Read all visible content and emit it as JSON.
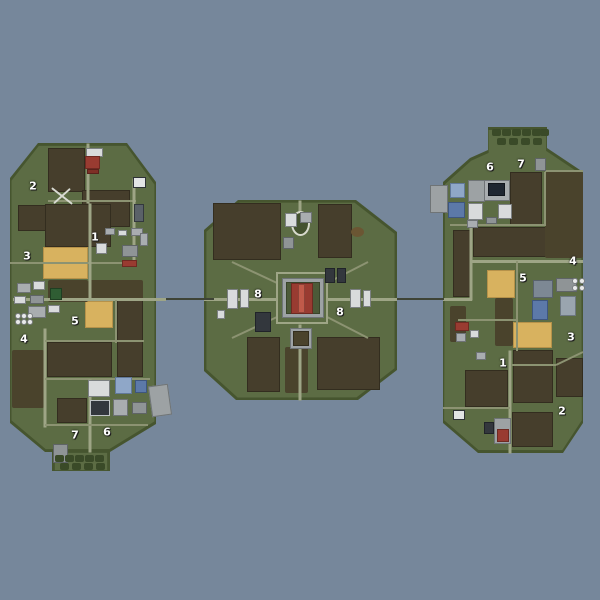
{
  "map_title": "",
  "colors": {
    "water": "#76879B",
    "land": "#5C6C44",
    "land_edge": "#46552F",
    "field_dark": "#463E2C",
    "field_dark_border": "#332D1F",
    "field_yellow": "#D8B25F",
    "field_yellow_border": "#B6924A",
    "road": "#9EA586",
    "road_minor": "#8C9372",
    "bridge": "#3F4436",
    "forest": "#4A432C",
    "hedge": "#3A4A28",
    "dirt": "#6B5633",
    "oval_ring": "#D8DACD",
    "oval_inner": "#44522F",
    "cross": "#D8DAD2",
    "silo": "#E9EAEA",
    "silo_border": "#7A7E80",
    "marker_text": "#FFFFFF"
  },
  "palette": {
    "white": [
      "#D9DBDC",
      "#7C8082"
    ],
    "gray": [
      "#A9ADB0",
      "#6F7376"
    ],
    "gray2": [
      "#8F9496",
      "#5F6466"
    ],
    "pad": [
      "#9DA2A4",
      "#6F7476"
    ],
    "dark": [
      "#33373D",
      "#202329"
    ],
    "navy": [
      "#1F2631",
      "#12161D"
    ],
    "blue": [
      "#5C79A8",
      "#3E567E"
    ],
    "blue2": [
      "#8FA7C8",
      "#62799A"
    ],
    "bluegray": [
      "#7D8894",
      "#59626C"
    ],
    "bluegray2": [
      "#9AA5AF",
      "#6E7881"
    ],
    "red": [
      "#993B31",
      "#6E2A22"
    ],
    "red2": [
      "#7E2F26",
      "#5A211B"
    ],
    "redLight": [
      "#C05A4A",
      "#8E4237"
    ],
    "green": [
      "#2F5D33",
      "#1F3F22"
    ],
    "green2": [
      "#4C5A38",
      "#39452A"
    ],
    "frame": [
      "#E2E4E5",
      "#2E3236"
    ],
    "panel": [
      "#5A6168",
      "#33383D"
    ],
    "darkframe": [
      "#33373D",
      "#C0C4C6"
    ],
    "forestPatch": [
      "#4A432C",
      "#332E1D"
    ]
  },
  "islands": [
    {
      "name": "west",
      "points": [
        [
          38,
          143
        ],
        [
          127,
          143
        ],
        [
          156,
          182
        ],
        [
          156,
          424
        ],
        [
          110,
          452
        ],
        [
          45,
          452
        ],
        [
          10,
          423
        ],
        [
          10,
          178
        ]
      ]
    },
    {
      "name": "west-spit",
      "points": [
        [
          52,
          452
        ],
        [
          110,
          452
        ],
        [
          110,
          471
        ],
        [
          52,
          471
        ]
      ]
    },
    {
      "name": "center",
      "points": [
        [
          238,
          200
        ],
        [
          356,
          200
        ],
        [
          397,
          232
        ],
        [
          397,
          370
        ],
        [
          358,
          400
        ],
        [
          236,
          400
        ],
        [
          204,
          371
        ],
        [
          204,
          230
        ]
      ]
    },
    {
      "name": "east",
      "points": [
        [
          470,
          158
        ],
        [
          488,
          150
        ],
        [
          488,
          127
        ],
        [
          547,
          127
        ],
        [
          547,
          148
        ],
        [
          583,
          172
        ],
        [
          583,
          423
        ],
        [
          563,
          453
        ],
        [
          478,
          453
        ],
        [
          443,
          423
        ],
        [
          443,
          182
        ]
      ]
    }
  ],
  "fields": [
    [
      48,
      148,
      37,
      44,
      "d"
    ],
    [
      18,
      205,
      28,
      26,
      "d"
    ],
    [
      82,
      190,
      48,
      37,
      "d"
    ],
    [
      45,
      204,
      66,
      43,
      "d"
    ],
    [
      43,
      247,
      45,
      32,
      "y"
    ],
    [
      85,
      301,
      28,
      27,
      "y"
    ],
    [
      117,
      300,
      26,
      77,
      "d"
    ],
    [
      47,
      342,
      65,
      35,
      "d"
    ],
    [
      57,
      398,
      30,
      25,
      "d"
    ],
    [
      213,
      203,
      68,
      57,
      "d"
    ],
    [
      318,
      204,
      34,
      54,
      "d"
    ],
    [
      247,
      337,
      33,
      55,
      "d"
    ],
    [
      317,
      337,
      63,
      53,
      "d"
    ],
    [
      510,
      172,
      32,
      53,
      "d"
    ],
    [
      473,
      227,
      77,
      30,
      "d"
    ],
    [
      453,
      230,
      19,
      67,
      "d"
    ],
    [
      487,
      270,
      28,
      28,
      "y"
    ],
    [
      513,
      322,
      39,
      26,
      "y"
    ],
    [
      513,
      350,
      40,
      53,
      "d"
    ],
    [
      556,
      358,
      27,
      39,
      "d"
    ],
    [
      465,
      370,
      43,
      37,
      "d"
    ],
    [
      512,
      412,
      41,
      35,
      "d"
    ]
  ],
  "forests": [
    [
      48,
      280,
      40,
      22
    ],
    [
      12,
      350,
      32,
      58
    ],
    [
      88,
      280,
      55,
      20
    ],
    [
      285,
      347,
      23,
      46
    ],
    [
      545,
      172,
      38,
      86
    ],
    [
      495,
      298,
      18,
      48
    ],
    [
      450,
      306,
      16,
      36
    ]
  ],
  "roads": [
    [
      88,
      143,
      88,
      203,
      3
    ],
    [
      48,
      201,
      136,
      201,
      2
    ],
    [
      134,
      178,
      134,
      263,
      3
    ],
    [
      10,
      263,
      134,
      263,
      2
    ],
    [
      90,
      203,
      90,
      300,
      3
    ],
    [
      13,
      299,
      166,
      299,
      3
    ],
    [
      116,
      300,
      116,
      343,
      2
    ],
    [
      45,
      328,
      45,
      427,
      3
    ],
    [
      45,
      341,
      144,
      341,
      2
    ],
    [
      45,
      379,
      150,
      379,
      2
    ],
    [
      90,
      379,
      90,
      452,
      3
    ],
    [
      45,
      425,
      148,
      425,
      2
    ],
    [
      300,
      200,
      300,
      225,
      3
    ],
    [
      204,
      299,
      277,
      299,
      3
    ],
    [
      327,
      299,
      397,
      299,
      3
    ],
    [
      300,
      324,
      300,
      400,
      3
    ],
    [
      232,
      262,
      277,
      283,
      2
    ],
    [
      368,
      262,
      327,
      283,
      2
    ],
    [
      232,
      338,
      277,
      317,
      2
    ],
    [
      368,
      338,
      327,
      317,
      2
    ],
    [
      443,
      299,
      472,
      299,
      3
    ],
    [
      471,
      225,
      471,
      300,
      3
    ],
    [
      450,
      225,
      546,
      225,
      2
    ],
    [
      545,
      172,
      545,
      225,
      2
    ],
    [
      545,
      171,
      583,
      171,
      2
    ],
    [
      472,
      261,
      583,
      261,
      3
    ],
    [
      517,
      261,
      517,
      351,
      2
    ],
    [
      458,
      320,
      517,
      320,
      2
    ],
    [
      510,
      350,
      510,
      453,
      3
    ],
    [
      512,
      365,
      556,
      365,
      2
    ],
    [
      556,
      365,
      583,
      352,
      2
    ],
    [
      443,
      408,
      510,
      408,
      2
    ]
  ],
  "rings": [
    [
      276,
      272,
      52,
      52
    ]
  ],
  "ovals": [
    [
      300,
      223,
      19,
      25,
      "ring"
    ],
    [
      357,
      232,
      13,
      10,
      "dirt"
    ]
  ],
  "bridges": [
    [
      166,
      298,
      214,
      298
    ],
    [
      397,
      298,
      444,
      298
    ]
  ],
  "buildings": [
    [
      86,
      148,
      17,
      9,
      "white"
    ],
    [
      85,
      156,
      15,
      13,
      "red"
    ],
    [
      87,
      169,
      12,
      5,
      "red2"
    ],
    [
      133,
      177,
      13,
      11,
      "frame"
    ],
    [
      134,
      204,
      10,
      18,
      "panel"
    ],
    [
      105,
      228,
      10,
      7,
      "gray"
    ],
    [
      118,
      230,
      9,
      6,
      "white"
    ],
    [
      131,
      228,
      12,
      8,
      "gray"
    ],
    [
      122,
      245,
      16,
      12,
      "gray2"
    ],
    [
      96,
      243,
      11,
      11,
      "white"
    ],
    [
      122,
      260,
      15,
      7,
      "red"
    ],
    [
      140,
      233,
      8,
      13,
      "gray"
    ],
    [
      17,
      283,
      14,
      10,
      "gray"
    ],
    [
      33,
      281,
      12,
      9,
      "white"
    ],
    [
      50,
      288,
      12,
      12,
      "green"
    ],
    [
      30,
      295,
      14,
      9,
      "gray2"
    ],
    [
      14,
      296,
      12,
      8,
      "white"
    ],
    [
      28,
      306,
      18,
      12,
      "gray"
    ],
    [
      48,
      305,
      12,
      8,
      "white"
    ],
    [
      88,
      380,
      22,
      17,
      "white"
    ],
    [
      115,
      377,
      17,
      17,
      "blue2"
    ],
    [
      135,
      380,
      12,
      13,
      "blue"
    ],
    [
      90,
      400,
      20,
      16,
      "darkframe"
    ],
    [
      113,
      399,
      15,
      17,
      "gray"
    ],
    [
      132,
      402,
      15,
      12,
      "gray2"
    ],
    [
      150,
      385,
      20,
      31,
      "pad",
      -8
    ],
    [
      53,
      444,
      15,
      19,
      "gray2"
    ],
    [
      285,
      213,
      12,
      14,
      "white"
    ],
    [
      300,
      212,
      12,
      11,
      "gray"
    ],
    [
      283,
      237,
      11,
      12,
      "gray2"
    ],
    [
      325,
      268,
      10,
      15,
      "dark"
    ],
    [
      337,
      268,
      9,
      15,
      "dark"
    ],
    [
      282,
      278,
      42,
      40,
      "pad"
    ],
    [
      286,
      282,
      34,
      32,
      "green2"
    ],
    [
      291,
      283,
      22,
      31,
      "red"
    ],
    [
      298,
      284,
      7,
      29,
      "redLight"
    ],
    [
      227,
      289,
      11,
      20,
      "white"
    ],
    [
      240,
      289,
      9,
      19,
      "white"
    ],
    [
      350,
      289,
      11,
      19,
      "white"
    ],
    [
      363,
      290,
      8,
      17,
      "white"
    ],
    [
      255,
      312,
      16,
      20,
      "dark"
    ],
    [
      290,
      328,
      22,
      21,
      "pad"
    ],
    [
      293,
      331,
      16,
      15,
      "forestPatch"
    ],
    [
      217,
      310,
      8,
      9,
      "white"
    ],
    [
      450,
      183,
      15,
      15,
      "blue2"
    ],
    [
      468,
      180,
      17,
      22,
      "pad"
    ],
    [
      484,
      180,
      26,
      21,
      "gray"
    ],
    [
      488,
      183,
      17,
      13,
      "navy"
    ],
    [
      448,
      202,
      17,
      16,
      "blue"
    ],
    [
      468,
      203,
      15,
      17,
      "white"
    ],
    [
      498,
      204,
      14,
      15,
      "white"
    ],
    [
      486,
      217,
      11,
      7,
      "gray2"
    ],
    [
      430,
      185,
      18,
      28,
      "pad"
    ],
    [
      535,
      158,
      11,
      13,
      "gray2"
    ],
    [
      467,
      220,
      11,
      8,
      "gray"
    ],
    [
      533,
      280,
      20,
      18,
      "bluegray"
    ],
    [
      556,
      278,
      21,
      14,
      "gray2"
    ],
    [
      560,
      296,
      16,
      20,
      "bluegray2"
    ],
    [
      532,
      300,
      16,
      20,
      "blue"
    ],
    [
      455,
      322,
      14,
      9,
      "red"
    ],
    [
      456,
      333,
      10,
      9,
      "gray"
    ],
    [
      470,
      330,
      9,
      8,
      "white"
    ],
    [
      453,
      410,
      12,
      10,
      "frame"
    ],
    [
      476,
      352,
      10,
      8,
      "gray"
    ],
    [
      494,
      418,
      17,
      26,
      "pad"
    ],
    [
      497,
      429,
      12,
      13,
      "red"
    ],
    [
      484,
      422,
      10,
      12,
      "dark"
    ]
  ],
  "silos": [
    [
      15,
      313
    ],
    [
      21,
      313
    ],
    [
      27,
      313
    ],
    [
      15,
      319
    ],
    [
      21,
      319
    ],
    [
      27,
      319
    ],
    [
      572,
      278
    ],
    [
      579,
      278
    ],
    [
      572,
      285
    ],
    [
      579,
      285
    ]
  ],
  "hedges": [
    [
      55,
      455
    ],
    [
      65,
      455
    ],
    [
      75,
      455
    ],
    [
      85,
      455
    ],
    [
      95,
      455
    ],
    [
      60,
      463
    ],
    [
      72,
      463
    ],
    [
      84,
      463
    ],
    [
      96,
      463
    ],
    [
      492,
      129
    ],
    [
      502,
      129
    ],
    [
      512,
      129
    ],
    [
      522,
      129
    ],
    [
      532,
      129
    ],
    [
      540,
      129
    ],
    [
      497,
      138
    ],
    [
      509,
      138
    ],
    [
      521,
      138
    ],
    [
      533,
      138
    ]
  ],
  "crosses": [
    [
      62,
      196
    ]
  ],
  "markers": [
    {
      "label": "2",
      "x": 33,
      "y": 186
    },
    {
      "label": "3",
      "x": 27,
      "y": 256
    },
    {
      "label": "1",
      "x": 95,
      "y": 237
    },
    {
      "label": "5",
      "x": 75,
      "y": 321
    },
    {
      "label": "4",
      "x": 24,
      "y": 339
    },
    {
      "label": "7",
      "x": 75,
      "y": 435
    },
    {
      "label": "6",
      "x": 107,
      "y": 432
    },
    {
      "label": "8",
      "x": 258,
      "y": 294
    },
    {
      "label": "8",
      "x": 340,
      "y": 312
    },
    {
      "label": "6",
      "x": 490,
      "y": 167
    },
    {
      "label": "7",
      "x": 521,
      "y": 164
    },
    {
      "label": "4",
      "x": 573,
      "y": 261
    },
    {
      "label": "5",
      "x": 523,
      "y": 278
    },
    {
      "label": "3",
      "x": 571,
      "y": 337
    },
    {
      "label": "1",
      "x": 503,
      "y": 363
    },
    {
      "label": "2",
      "x": 562,
      "y": 411
    }
  ]
}
